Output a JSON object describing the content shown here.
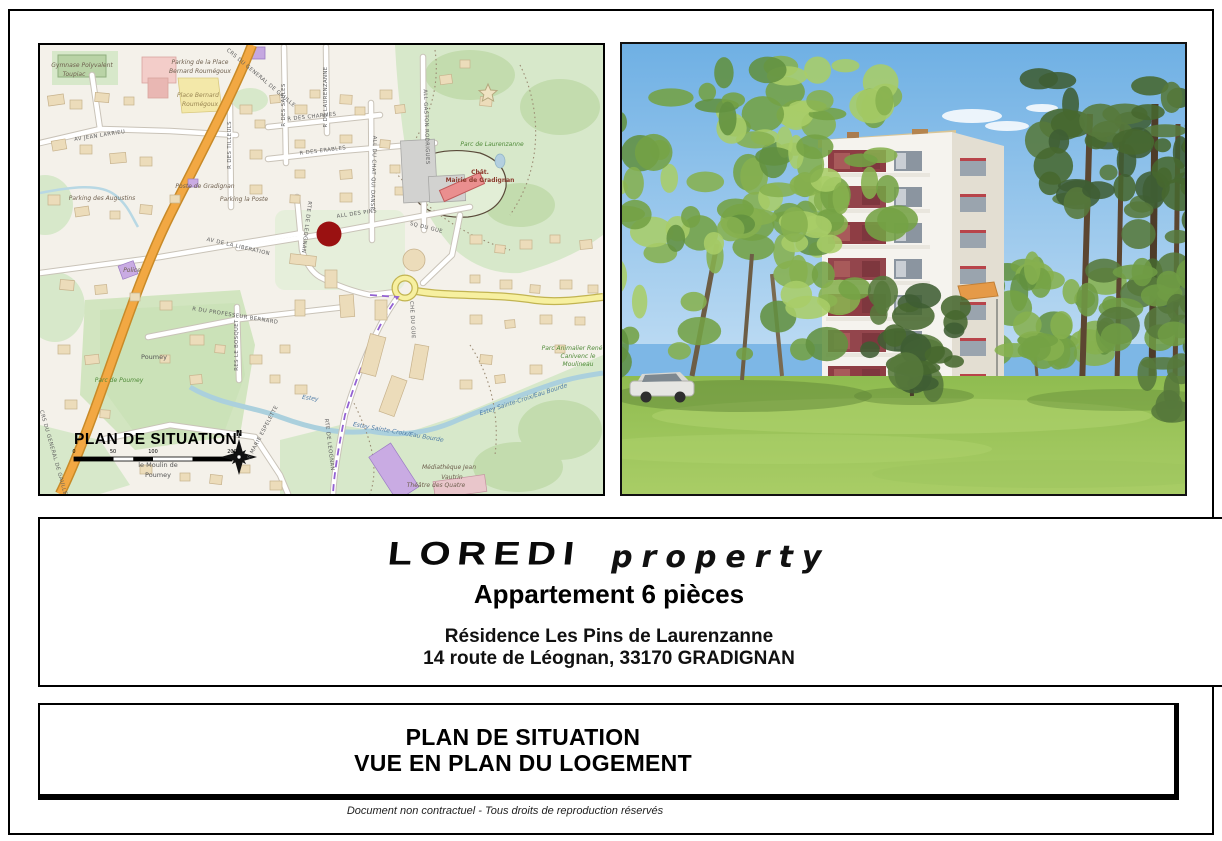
{
  "page": {
    "footer": "Document non contractuel  -  Tous droits de reproduction réservés"
  },
  "info": {
    "logo_main": "LOREDI",
    "logo_sub": "property",
    "title": "Appartement 6 pièces",
    "address_line1": "Résidence Les Pins de Laurenzanne",
    "address_line2": "14 route de Léognan, 33170 GRADIGNAN"
  },
  "banner": {
    "line1": "PLAN DE SITUATION",
    "line2": "VUE EN PLAN DU LOGEMENT"
  },
  "colors": {
    "marker_red": "#9a1111",
    "main_road_orange": "#f2a843",
    "secondary_road_yellow": "#f7f0a0",
    "park_green": "#d7e8ca",
    "water_blue": "#abd0dd",
    "accent_purple": "#c9abe3",
    "mairie_red": "#ea8f8f"
  },
  "map": {
    "labels": [
      {
        "t": "PLAN DE SITUATION",
        "x": 34,
        "y": 399,
        "c": "title",
        "a": "start"
      },
      {
        "t": "0",
        "x": 34,
        "y": 408,
        "c": "scale"
      },
      {
        "t": "50",
        "x": 73,
        "y": 408,
        "c": "scale"
      },
      {
        "t": "100",
        "x": 113,
        "y": 408,
        "c": "scale"
      },
      {
        "t": "200",
        "x": 192,
        "y": 408,
        "c": "scale"
      },
      {
        "t": "N",
        "x": 199,
        "y": 391,
        "c": "north"
      },
      {
        "t": "Gymnase Polyvalent",
        "x": 42,
        "y": 22,
        "c": "poi"
      },
      {
        "t": "Toupiac",
        "x": 34,
        "y": 31,
        "c": "poi"
      },
      {
        "t": "Parking de la Place",
        "x": 160,
        "y": 19,
        "c": "poi"
      },
      {
        "t": "Bernard Roumégoux",
        "x": 160,
        "y": 28,
        "c": "poi"
      },
      {
        "t": "Place Bernard",
        "x": 158,
        "y": 52,
        "c": "place"
      },
      {
        "t": "Roumégoux",
        "x": 160,
        "y": 61,
        "c": "place"
      },
      {
        "t": "AV JEAN LARRIEU",
        "x": 60,
        "y": 92,
        "r": -9,
        "c": "road"
      },
      {
        "t": "CRS DU GENERAL DE GAULLE",
        "x": 220,
        "y": 34,
        "r": 40,
        "c": "road"
      },
      {
        "t": "R DES SAULES",
        "x": 245,
        "y": 60,
        "r": -90,
        "c": "road"
      },
      {
        "t": "R DE LAURENZANNE",
        "x": 287,
        "y": 52,
        "r": -90,
        "c": "road"
      },
      {
        "t": "R DES TILLEULS",
        "x": 191,
        "y": 100,
        "r": -90,
        "c": "road"
      },
      {
        "t": "R DES CHARMES",
        "x": 272,
        "y": 73,
        "r": -6,
        "c": "road"
      },
      {
        "t": "R DES ERABLES",
        "x": 283,
        "y": 107,
        "r": -7,
        "c": "road"
      },
      {
        "t": "ALL GASTON RODRIGUES",
        "x": 385,
        "y": 82,
        "r": 88,
        "c": "road"
      },
      {
        "t": "ALL DU CHAT QUI DANSE",
        "x": 332,
        "y": 128,
        "r": 92,
        "c": "road"
      },
      {
        "t": "Parc de Laurenzanne",
        "x": 452,
        "y": 101,
        "c": "park"
      },
      {
        "t": "Chât.",
        "x": 440,
        "y": 129,
        "c": "mairie"
      },
      {
        "t": "Mairie de Gradignan",
        "x": 440,
        "y": 137,
        "c": "mairie"
      },
      {
        "t": "Poste de Gradignan",
        "x": 165,
        "y": 143,
        "c": "poi"
      },
      {
        "t": "Parking la Poste",
        "x": 204,
        "y": 156,
        "c": "poi"
      },
      {
        "t": "Parking des Augustins",
        "x": 62,
        "y": 155,
        "c": "poi"
      },
      {
        "t": "ALL DES PINS",
        "x": 317,
        "y": 170,
        "r": -8,
        "c": "road"
      },
      {
        "t": "SQ DU GUE",
        "x": 386,
        "y": 184,
        "r": 14,
        "c": "road"
      },
      {
        "t": "RTE DE LEOGNAN",
        "x": 265,
        "y": 182,
        "r": 97,
        "c": "road"
      },
      {
        "t": "AV DE LA LIBERATION",
        "x": 198,
        "y": 203,
        "r": 13,
        "c": "road"
      },
      {
        "t": "Police",
        "x": 92,
        "y": 227,
        "c": "poi"
      },
      {
        "t": "R DU PROFESSEUR BERNARD",
        "x": 195,
        "y": 272,
        "r": 9,
        "c": "road"
      },
      {
        "t": "RES LE BOSQUET",
        "x": 198,
        "y": 300,
        "r": -90,
        "c": "road"
      },
      {
        "t": "CHE DU GUE",
        "x": 371,
        "y": 275,
        "r": 87,
        "c": "road"
      },
      {
        "t": "Poumey",
        "x": 114,
        "y": 314,
        "c": "pname"
      },
      {
        "t": "Parc de Poumey",
        "x": 79,
        "y": 337,
        "c": "park"
      },
      {
        "t": "Estey",
        "x": 270,
        "y": 355,
        "r": 8,
        "c": "water"
      },
      {
        "t": "Estey Sainte-Croix/Eau Bourde",
        "x": 358,
        "y": 389,
        "r": 10,
        "c": "water"
      },
      {
        "t": "Estey Sainte-Croix/Eau Bourde",
        "x": 484,
        "y": 356,
        "r": -18,
        "c": "water"
      },
      {
        "t": "Parc Animalier René",
        "x": 532,
        "y": 305,
        "c": "park"
      },
      {
        "t": "Canivenc le",
        "x": 538,
        "y": 313,
        "c": "park"
      },
      {
        "t": "Moulineau",
        "x": 538,
        "y": 321,
        "c": "park"
      },
      {
        "t": "R MARIE ESPELETTE",
        "x": 224,
        "y": 388,
        "r": -62,
        "c": "road"
      },
      {
        "t": "RTE DE LEOGNAN",
        "x": 288,
        "y": 400,
        "r": 83,
        "c": "road"
      },
      {
        "t": "CRS DU GENERAL DE GAULLE",
        "x": 12,
        "y": 408,
        "r": 74,
        "c": "road"
      },
      {
        "t": "le Moulin de",
        "x": 118,
        "y": 422,
        "c": "pname"
      },
      {
        "t": "Poumey",
        "x": 118,
        "y": 432,
        "c": "pname"
      },
      {
        "t": "Médiathèque Jean",
        "x": 409,
        "y": 424,
        "c": "poi"
      },
      {
        "t": "Vautrin",
        "x": 412,
        "y": 434,
        "c": "poi"
      },
      {
        "t": "Théâtre des Quatre",
        "x": 396,
        "y": 442,
        "c": "poi"
      }
    ]
  }
}
